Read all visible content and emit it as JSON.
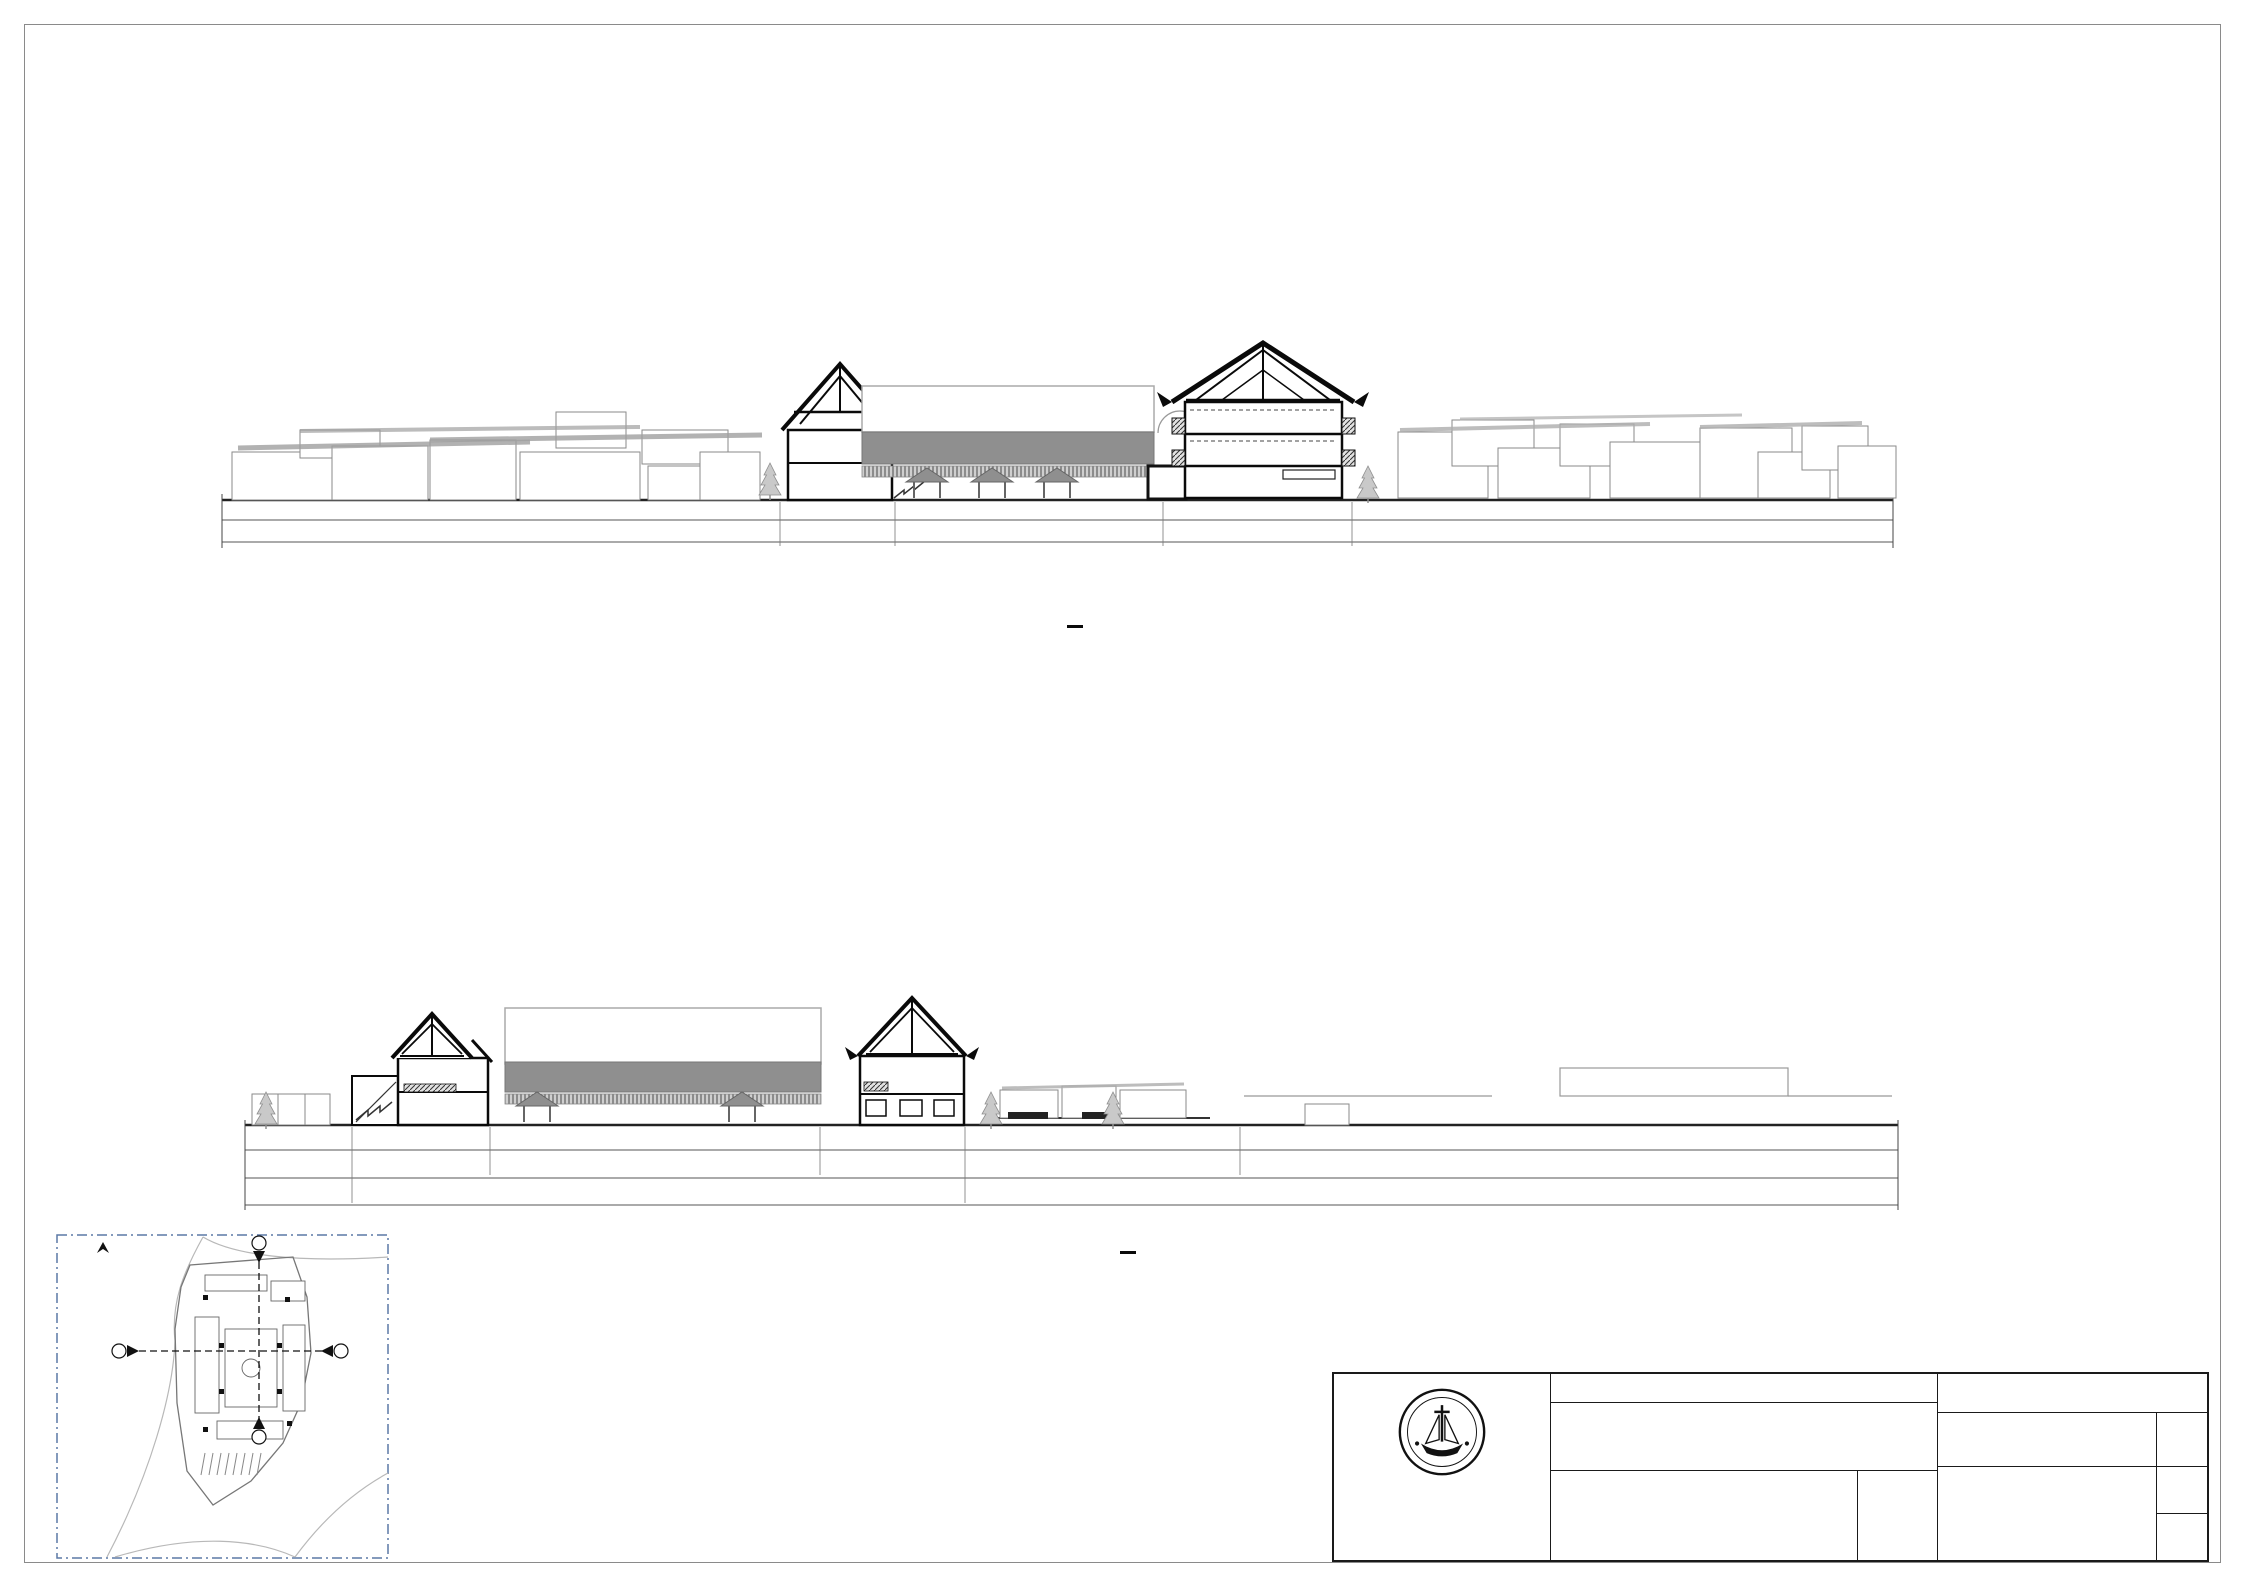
{
  "sections": [
    {
      "id": "a",
      "title": "POTONGAN TAPAK A-A",
      "scale_note": "SKALA 1 : 400",
      "title_cx": 1075,
      "title_y": 622,
      "scale_y": 662,
      "callouts": [
        {
          "text": "DESA SADE",
          "cx": 660,
          "top": 278,
          "arrow_x": 660,
          "arrow_top": 306,
          "arrow_bot": 448
        },
        {
          "text": "MASSA WORKSHOP\nPENENUNAN &\nMENJAHIT",
          "cx": 836,
          "top": 228,
          "arrow_x": 836,
          "arrow_top": 300,
          "arrow_bot": 360
        },
        {
          "text": "MASSA TOKO &\nFOODCOURT",
          "cx": 998,
          "top": 272,
          "arrow_x": 995,
          "arrow_top": 322,
          "arrow_bot": 384
        },
        {
          "text": "MASSA WORKSHOP\nPENENUNAN &\nMENJAHIT",
          "cx": 1262,
          "top": 168,
          "arrow_x": 1262,
          "arrow_top": 240,
          "arrow_bot": 340
        },
        {
          "text": "PERMUKIMAN",
          "cx": 1517,
          "top": 288,
          "arrow_x": 1516,
          "arrow_top": 316,
          "arrow_bot": 402
        }
      ],
      "elevations": {
        "x": 1963,
        "line_top": 320,
        "line_bot": 506,
        "tick_left": 1890,
        "tick_right": 2040,
        "marks": [
          {
            "text": "+16,20",
            "y": 340
          },
          {
            "text": "+11,50",
            "y": 380
          },
          {
            "text": "+10,50",
            "y": 396
          },
          {
            "text": "+7,00",
            "y": 433
          },
          {
            "text": "+3,50",
            "y": 466
          },
          {
            "text": "±0.00",
            "y": 500
          }
        ]
      },
      "rooms": [
        {
          "lines": [
            "AREA WORKSHOP",
            "MENJAHIT",
            "+3.50"
          ],
          "cx": 838,
          "y": 441,
          "size": 7.5,
          "color": "#111"
        },
        {
          "lines": [
            "AREA WORKSHOP",
            "MENENUN",
            "+0.50"
          ],
          "cx": 838,
          "y": 473,
          "size": 7.5,
          "color": "#111"
        },
        {
          "lines": [
            "RUANG TENGAH",
            "±0.20"
          ],
          "cx": 972,
          "y": 484,
          "size": 8,
          "color": "#9a9a9a"
        },
        {
          "lines": [
            "PANGGUNG",
            "+0.50"
          ],
          "cx": 1106,
          "y": 484,
          "size": 8,
          "color": "#9a9a9a"
        },
        {
          "lines": [
            "RUANG",
            "PENYIMPANAN",
            "+3.50"
          ],
          "cx": 1167,
          "y": 476,
          "size": 6,
          "color": "#222"
        },
        {
          "lines": [
            "R. SERBAGUNA",
            "+7.00"
          ],
          "cx": 1263,
          "y": 415,
          "size": 8.5,
          "color": "#111"
        },
        {
          "lines": [
            "GALLERY KAIN DAN",
            "PRODUK FASHION SHOW",
            "+3.50"
          ],
          "cx": 1263,
          "y": 443,
          "size": 7.5,
          "color": "#111"
        },
        {
          "lines": [
            "MUSEUM",
            "±0.00"
          ],
          "cx": 1263,
          "y": 481,
          "size": 8.5,
          "color": "#111"
        }
      ],
      "dims": {
        "row1_y": 520,
        "row2_y": 542,
        "row1": [
          {
            "text": "54.86",
            "x": 480
          },
          {
            "text": "3.02",
            "x": 754
          },
          {
            "text": "4.02",
            "x": 800
          },
          {
            "text": "6.35",
            "x": 852
          },
          {
            "text": "2.36",
            "x": 877
          },
          {
            "text": "20.01",
            "x": 981
          },
          {
            "text": "3.20",
            "x": 1091
          },
          {
            "text": "5.00",
            "x": 1130
          },
          {
            "text": "3.52",
            "x": 1173
          },
          {
            "text": "2.00",
            "x": 1198
          },
          {
            "text": "12.00",
            "x": 1262
          },
          {
            "text": "4.82",
            "x": 1343
          },
          {
            "text": "3.06",
            "x": 1383
          },
          {
            "text": "55.79",
            "x": 1658
          }
        ],
        "row2": [
          {
            "text": "180.00",
            "x": 1070
          }
        ]
      },
      "bubbles": {
        "stem_top": 502,
        "items": [
          {
            "text": "13",
            "x": 806,
            "y": 597
          },
          {
            "text": "11",
            "x": 868,
            "y": 597
          },
          {
            "text": "10",
            "x": 920,
            "y": 597
          },
          {
            "text": "9",
            "x": 974,
            "y": 597
          },
          {
            "text": "8",
            "x": 1030,
            "y": 597
          },
          {
            "text": "7",
            "x": 1087,
            "y": 597
          },
          {
            "text": "6",
            "x": 1113,
            "y": 597
          },
          {
            "text": "5",
            "x": 1132,
            "y": 617
          },
          {
            "text": "4",
            "x": 1181,
            "y": 597
          },
          {
            "text": "3",
            "x": 1215,
            "y": 597
          },
          {
            "text": "2",
            "x": 1265,
            "y": 597
          },
          {
            "text": "1",
            "x": 1320,
            "y": 597
          }
        ]
      }
    },
    {
      "id": "b",
      "title": "POTONGAN TAPAK B-B",
      "scale_note": "SKALA 1 : 400",
      "title_cx": 1128,
      "title_y": 1248,
      "scale_y": 1288,
      "callouts": [
        {
          "text": "MASSA WORKSHOP\nPEMINTALAN &\nPEWARNAAN",
          "cx": 435,
          "top": 840,
          "arrow_x": 433,
          "arrow_top": 912,
          "arrow_bot": 1012
        },
        {
          "text": "MASSA WORKSHOP\nPENENUNAN &\nMENJAHIT",
          "cx": 660,
          "top": 860,
          "arrow_x": 660,
          "arrow_top": 933,
          "arrow_bot": 1006
        },
        {
          "text": "MASSA TOKO &\nFOODCOURT",
          "cx": 900,
          "top": 880,
          "arrow_x": 912,
          "arrow_top": 930,
          "arrow_bot": 996
        },
        {
          "text": "DESA SADE",
          "cx": 1148,
          "top": 903,
          "arrow_x": 1147,
          "arrow_top": 932,
          "arrow_bot": 1086
        },
        {
          "text": "AREA PARKIR",
          "cx": 1252,
          "top": 952,
          "arrow_x": 1248,
          "arrow_top": 980,
          "arrow_bot": 1092
        }
      ],
      "elevations": {
        "x": 1983,
        "line_top": 975,
        "line_bot": 1122,
        "tick_left": 1900,
        "tick_right": 2056,
        "marks": [
          {
            "text": "+11,50",
            "y": 998
          },
          {
            "text": "+7,00",
            "y": 1050
          },
          {
            "text": "+3,50",
            "y": 1079
          },
          {
            "text": "±0.00",
            "y": 1117
          }
        ]
      },
      "rooms": [
        {
          "lines": [
            "AREA JEMUR",
            "+3.50"
          ],
          "cx": 434,
          "y": 1074,
          "size": 7,
          "color": "#111"
        },
        {
          "lines": [
            "AREA WORKSHOP",
            "PEMINTALAN",
            "±0.00"
          ],
          "cx": 437,
          "y": 1100,
          "size": 7.5,
          "color": "#111"
        },
        {
          "lines": [
            "RUANG TENGAH",
            "±0.20"
          ],
          "cx": 662,
          "y": 1110,
          "size": 8,
          "color": "#9a9a9a"
        },
        {
          "lines": [
            "FOOD COURT",
            "+3.50"
          ],
          "cx": 918,
          "y": 1070,
          "size": 8,
          "color": "#111"
        },
        {
          "lines": [
            "TOKO OLEH-OLEH",
            "±0.00"
          ],
          "cx": 912,
          "y": 1106,
          "size": 8,
          "color": "#111"
        }
      ],
      "dims": {
        "row1_y": 1150,
        "row2_y": 1178,
        "row3_y": 1205,
        "row1": [
          {
            "text": "0.66",
            "x": 295
          },
          {
            "text": "2.16",
            "x": 348
          },
          {
            "text": "5.00",
            "x": 382
          },
          {
            "text": "6.37",
            "x": 436
          },
          {
            "text": "1.99",
            "x": 470
          },
          {
            "text": "5.45",
            "x": 507
          },
          {
            "text": "8.01",
            "x": 571
          },
          {
            "text": "6.86",
            "x": 641
          },
          {
            "text": "10.98",
            "x": 723
          },
          {
            "text": "5.54",
            "x": 803
          },
          {
            "text": "11.03",
            "x": 881
          }
        ],
        "row2": [
          {
            "text": "27.33",
            "x": 1061
          },
          {
            "text": "74.92",
            "x": 1546
          }
        ],
        "row3": [
          {
            "text": "174.30",
            "x": 455
          }
        ]
      },
      "bubbles": {
        "stem_top": 1152,
        "items": [
          {
            "text": "A",
            "x": 337,
            "y": 1226
          },
          {
            "text": "C",
            "x": 358,
            "y": 1249
          },
          {
            "text": "D",
            "x": 406,
            "y": 1226
          },
          {
            "text": "F",
            "x": 464,
            "y": 1226
          },
          {
            "text": "G",
            "x": 484,
            "y": 1249
          },
          {
            "text": "H",
            "x": 536,
            "y": 1226
          },
          {
            "text": "I",
            "x": 599,
            "y": 1226
          },
          {
            "text": "J",
            "x": 659,
            "y": 1226
          },
          {
            "text": "K",
            "x": 719,
            "y": 1226
          },
          {
            "text": "L",
            "x": 780,
            "y": 1226
          },
          {
            "text": "M",
            "x": 832,
            "y": 1226
          },
          {
            "text": "N",
            "x": 877,
            "y": 1222
          },
          {
            "text": "O",
            "x": 936,
            "y": 1226
          }
        ]
      }
    }
  ],
  "keymap": {
    "marker_a": "A",
    "marker_b": "B"
  },
  "titleblock": {
    "header": "TUGAS AKHIR - SEMESTER GANJIL 2022/2023",
    "judul_tugas_label": "JUDUL TUGAS",
    "judul_tugas_1": "FASILITAS WISATA EDUKASI KAIN TENUN KHAS",
    "judul_tugas_2": "LOMBOK DI LOMBOK TENGAH",
    "judul_gambar_label": "JUDUL GAMBAR",
    "judul_gambar": "POTONGAN TAPAK",
    "skala_label": "SKALA",
    "skala_value": "1:400",
    "nama_label": "NAMA",
    "nama_value": "ALMIRA WIRAWAN",
    "nrp_label": "NRP",
    "nrp_value": "B12180005",
    "kelompok_label": "KELOMPOK",
    "kelompok_value": "I",
    "mentor_utama_label": "MENTOR UTAMA",
    "mentor_utama_value": "IR. WANDA WIDIGDO, M. SI.",
    "mentor_pendamping_label": "MENTOR PENDAMPING",
    "mentor_pendamping_1": "IR. M.I. ADICIPTO, M. ARCH.",
    "mentor_pendamping_2": "IR. NUGROHO SUSILO, M. BDG. SC.",
    "lembar_label": "LEMBAR",
    "jumlah_label": "JUMLAH",
    "institute_line1": "PROGRAM STUDI ARSITEKTUR",
    "institute_line2": "FAKULTAS TEKNIK SIPIL DAN PERENCANAAN",
    "institute_line3": "UNIVERSITAS KRISTEN PETRA",
    "institute_line4": "SURABAYA",
    "logo_top": "UNIVERSITAS KRISTEN",
    "logo_bottom": "PETRA"
  }
}
